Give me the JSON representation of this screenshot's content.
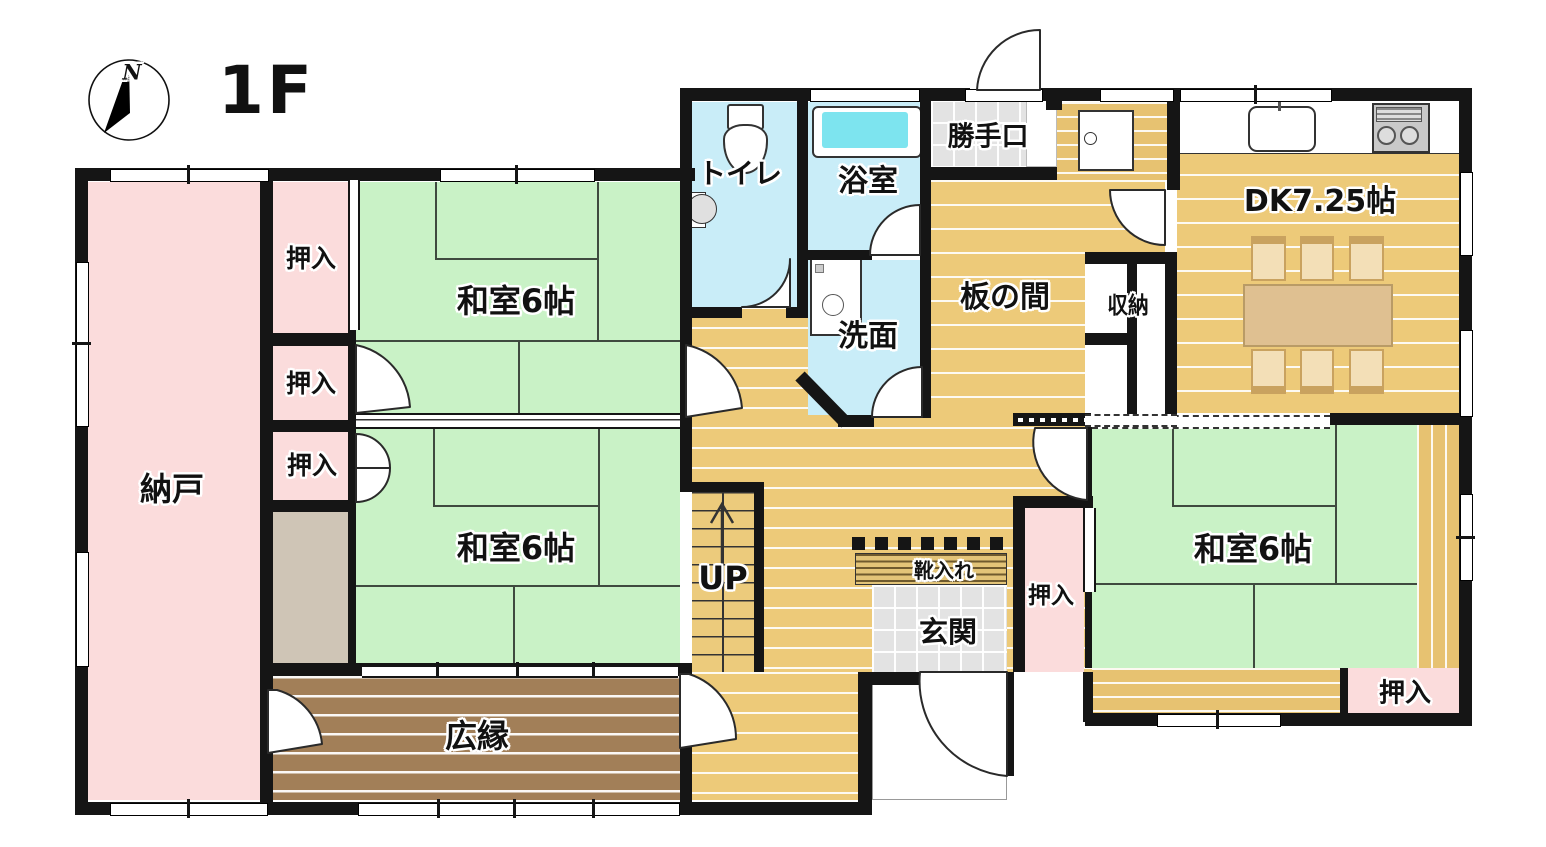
{
  "title": "1F",
  "compass": {
    "letter": "N"
  },
  "rooms": {
    "nando": "納戸",
    "oshiire": "押入",
    "washitsu6": "和室6帖",
    "hiroen": "広縁",
    "toilet": "トイレ",
    "bath": "浴室",
    "senmen": "洗面",
    "katteguchi": "勝手口",
    "itanoma": "板の間",
    "shuno": "収納",
    "dk": "DK7.25帖",
    "up": "UP",
    "genkan": "玄関",
    "kutsuire": "靴入れ"
  },
  "colors": {
    "tatami_green": "#c9f2c6",
    "closet_pink": "#fbdcdc",
    "water_cyan": "#c9edf8",
    "bathtub_cyan": "#7de4ef",
    "wood_floor": "#edca79",
    "veranda_brown": "#a27f58",
    "tile_gray": "#e3e3e3",
    "wall_black": "#151515"
  }
}
